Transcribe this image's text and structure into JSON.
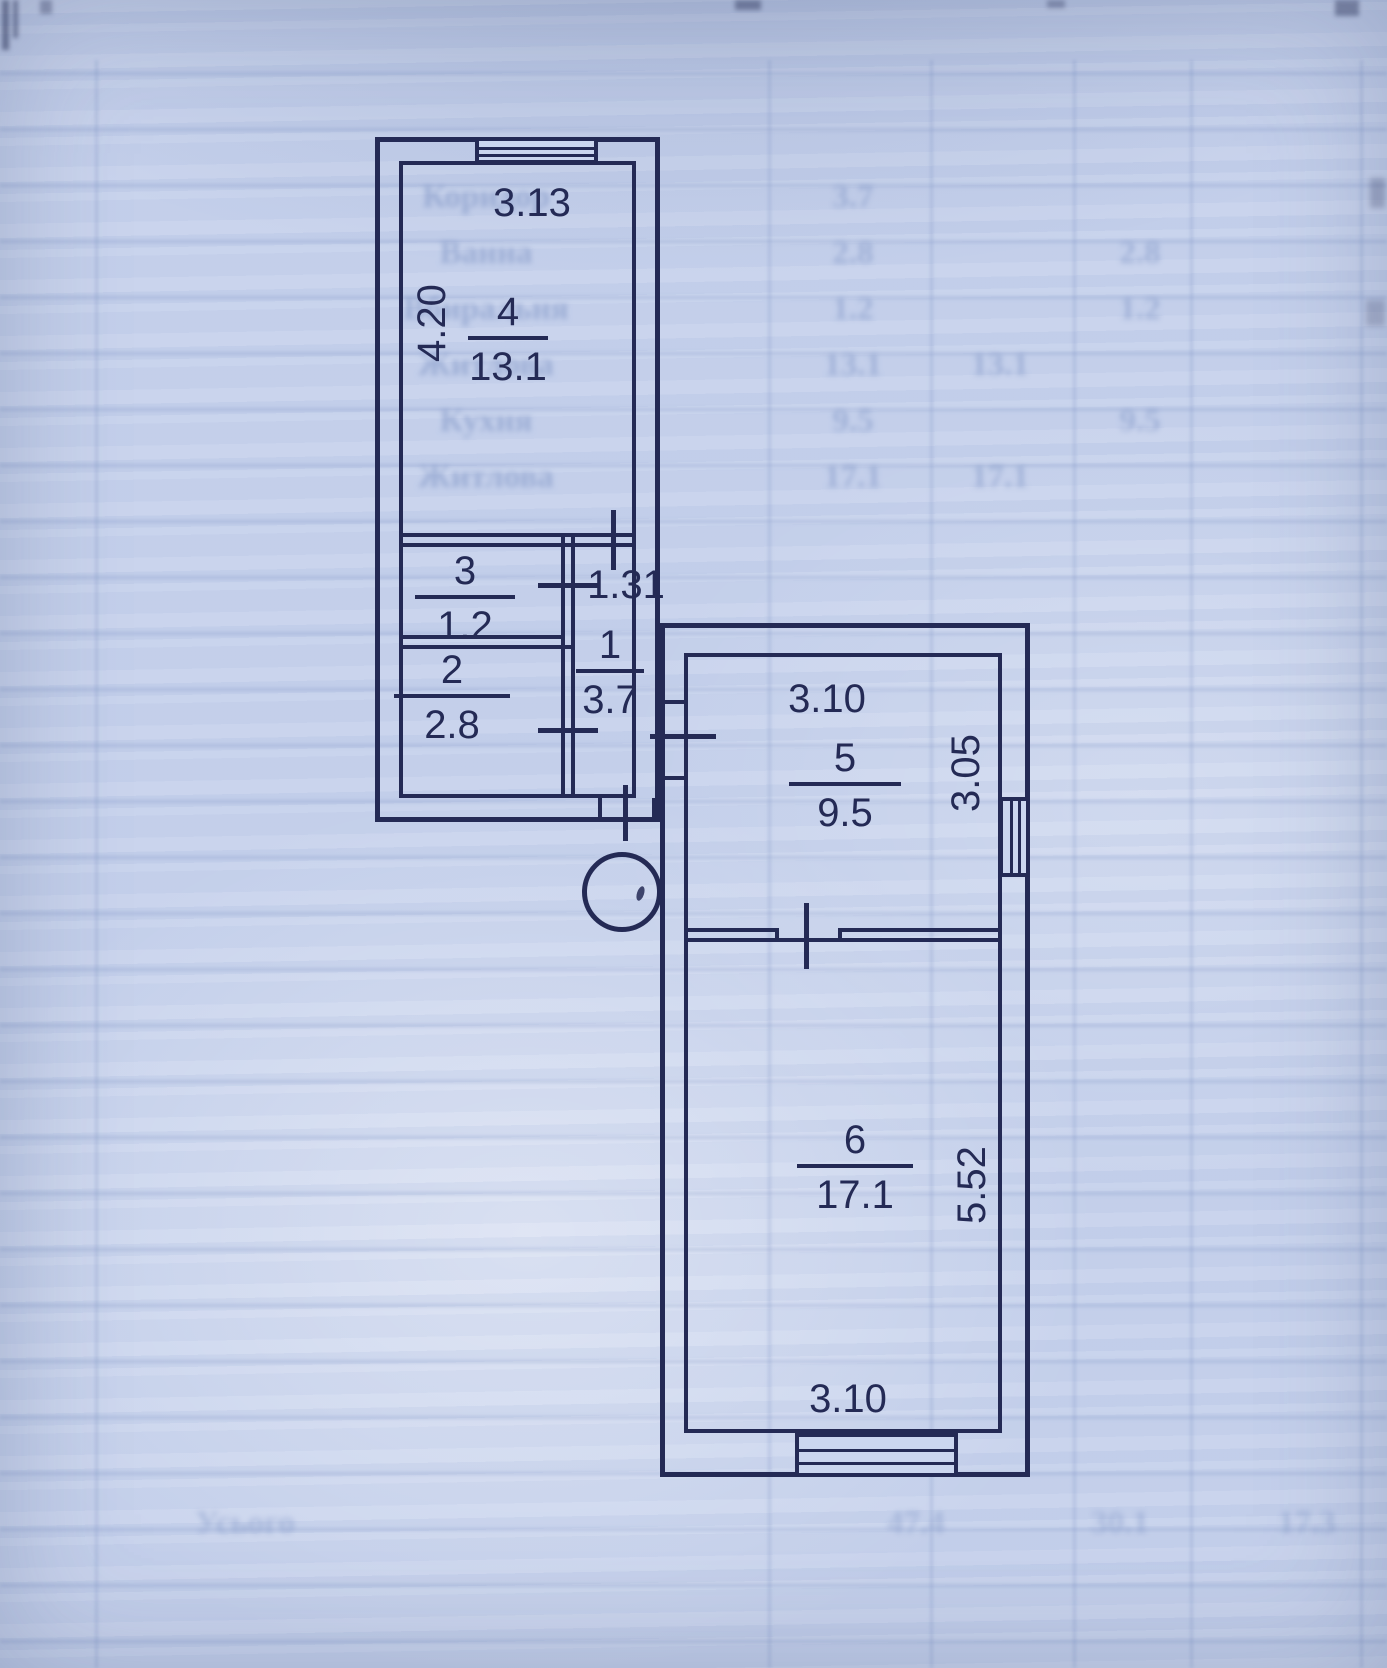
{
  "plan": {
    "rooms": [
      {
        "number": "1",
        "area": "3.7"
      },
      {
        "number": "2",
        "area": "2.8"
      },
      {
        "number": "3",
        "area": "1.2"
      },
      {
        "number": "4",
        "area": "13.1"
      },
      {
        "number": "5",
        "area": "9.5"
      },
      {
        "number": "6",
        "area": "17.1"
      }
    ],
    "dimensions": {
      "room4_width": "3.13",
      "room4_height": "4.20",
      "hall_width": "1.31",
      "room5_width": "3.10",
      "room5_height": "3.05",
      "room6_height": "5.52",
      "room6_width": "3.10"
    },
    "colors": {
      "ink": "#242a55",
      "paper": "#c7d2ec"
    }
  },
  "ghost_table": {
    "rows": [
      {
        "label": "Коридор",
        "c1": "3.7",
        "c2": "",
        "c3": ""
      },
      {
        "label": "Ванна",
        "c1": "2.8",
        "c2": "",
        "c3": "2.8"
      },
      {
        "label": "Вбиральня",
        "c1": "1.2",
        "c2": "",
        "c3": "1.2"
      },
      {
        "label": "Житлова",
        "c1": "13.1",
        "c2": "13.1",
        "c3": ""
      },
      {
        "label": "Кухня",
        "c1": "9.5",
        "c2": "",
        "c3": "9.5"
      },
      {
        "label": "Житлова",
        "c1": "17.1",
        "c2": "17.1",
        "c3": ""
      }
    ],
    "totals": {
      "label": "Усього",
      "c1": "47.4",
      "c2": "30.1",
      "c3": "17.3"
    }
  }
}
